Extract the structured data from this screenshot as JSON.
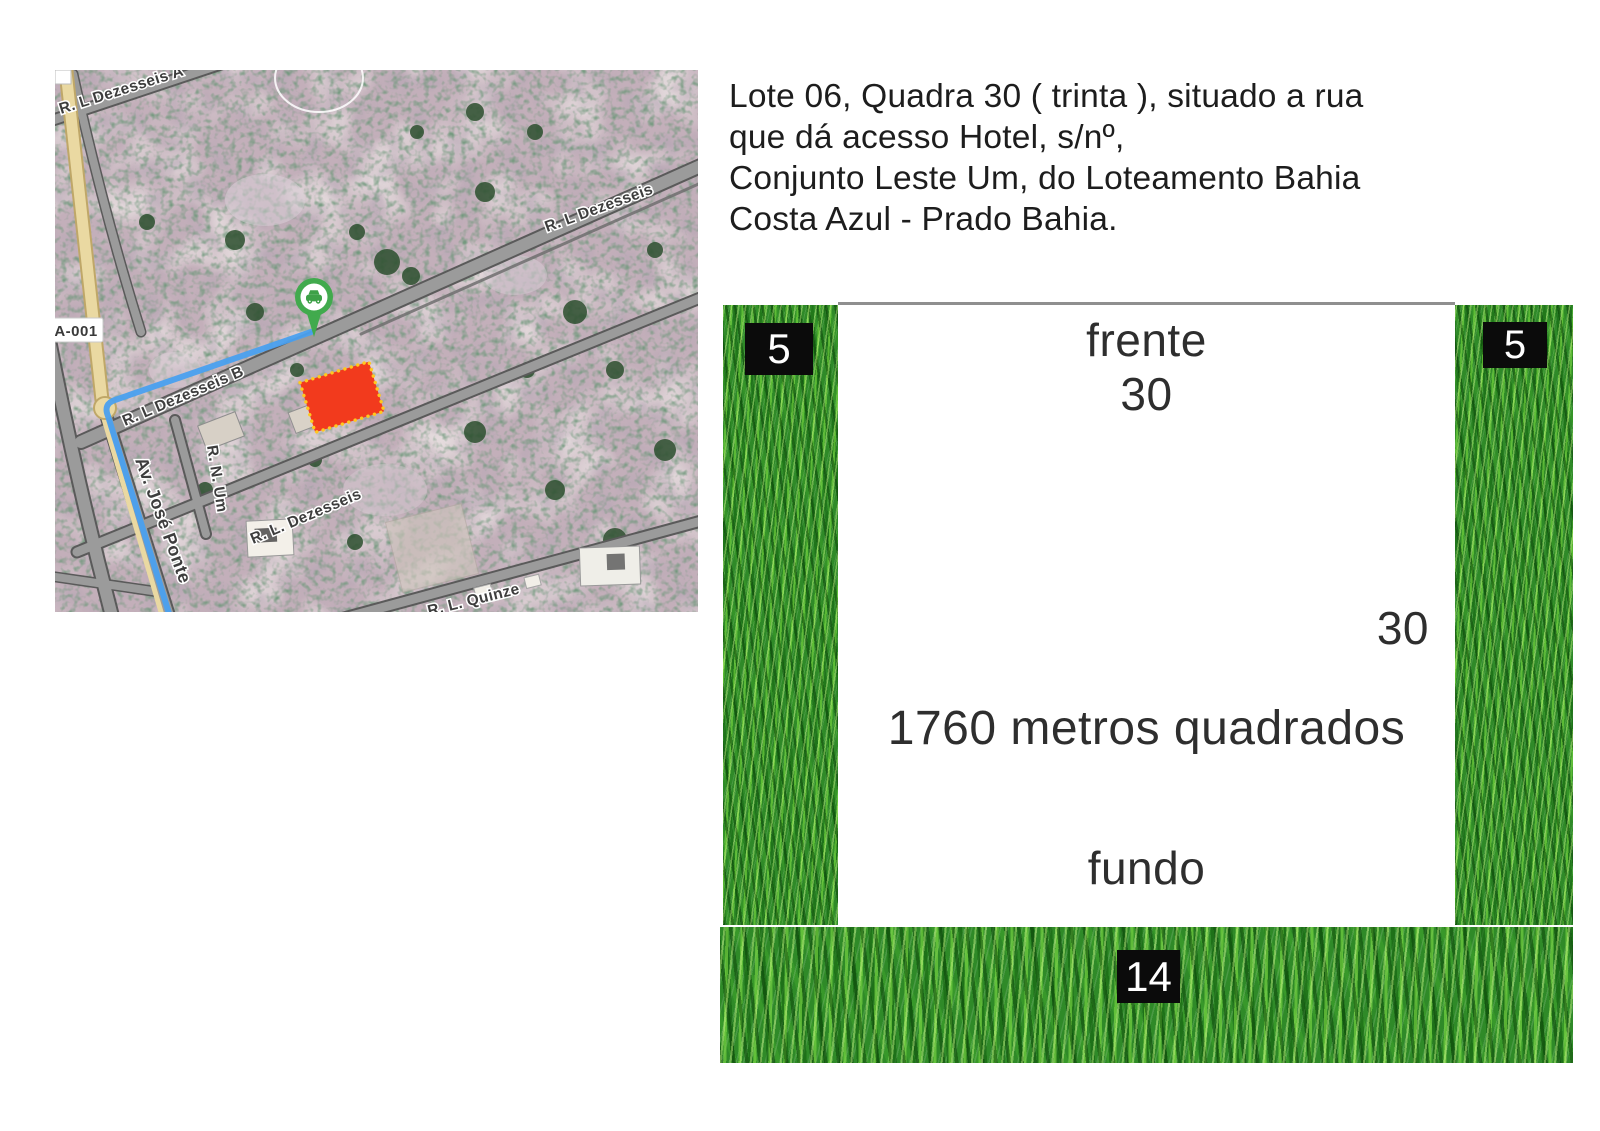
{
  "description": {
    "text": "Lote 06, Quadra 30 ( trinta ), situado a rua\nque dá acesso Hotel, s/nº,\nConjunto Leste Um, do Loteamento Bahia\nCosta Azul - Prado Bahia."
  },
  "map": {
    "route_ref": "BA-001",
    "streets": {
      "dezesseis_a": "R. L Dezesseis A",
      "dezesseis_right": "R. L Dezesseis",
      "dezesseis_b": "R. L Dezesseis B",
      "dezesseis_lower": "R. L. Dezesseis",
      "quinze": "R. L. Quinze",
      "num": "R. N. Um",
      "jose_pontes": "Av. José Ponte"
    },
    "colors": {
      "lot_fill": "#f23a1d",
      "lot_border": "#ffc81f",
      "route_line": "#4aa0ef",
      "pin_green": "#41aa4d"
    }
  },
  "diagram": {
    "front_label": "frente",
    "front_value": "30",
    "right_value": "30",
    "area_text": "1760 metros quadrados",
    "back_label": "fundo",
    "corner_left": "5",
    "corner_right": "5",
    "bottom_value": "14",
    "grass_color": "#2f8a28",
    "marker_bg": "#0b0b0b"
  }
}
